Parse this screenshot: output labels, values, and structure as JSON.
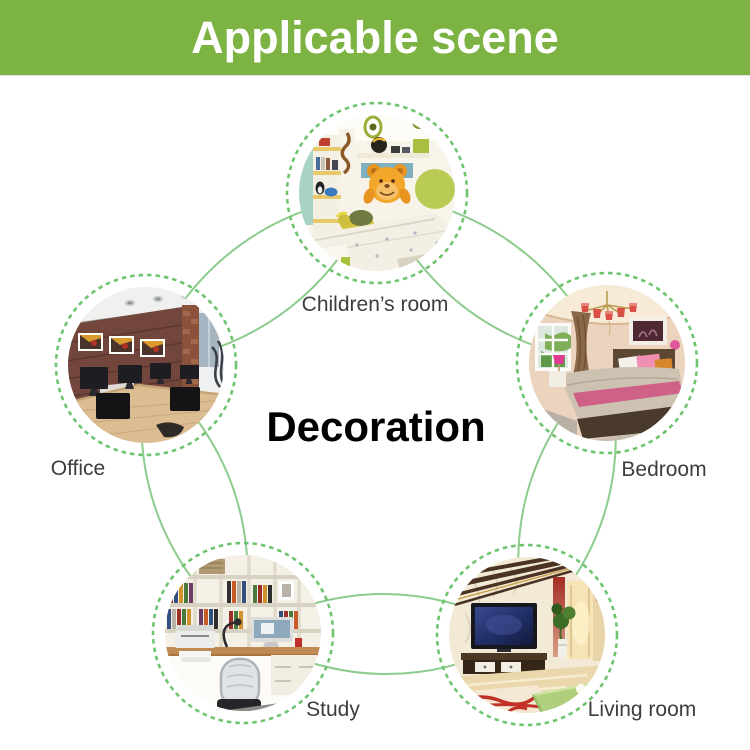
{
  "header": {
    "title": "Applicable scene",
    "bg_color": "#7cb342",
    "text_color": "#ffffff"
  },
  "center": {
    "label": "Decoration"
  },
  "nodes": [
    {
      "id": "children-room",
      "label": "Children’s room",
      "position": "top"
    },
    {
      "id": "office",
      "label": "Office",
      "position": "upper-left"
    },
    {
      "id": "bedroom",
      "label": "Bedroom",
      "position": "upper-right"
    },
    {
      "id": "study",
      "label": "Study",
      "position": "lower-left"
    },
    {
      "id": "living-room",
      "label": "Living room",
      "position": "lower-right"
    }
  ],
  "colors": {
    "connector_green": "#8ccc8c",
    "dashed_ring_green": "#6fc46f",
    "label_gray": "#3d3d3d"
  }
}
